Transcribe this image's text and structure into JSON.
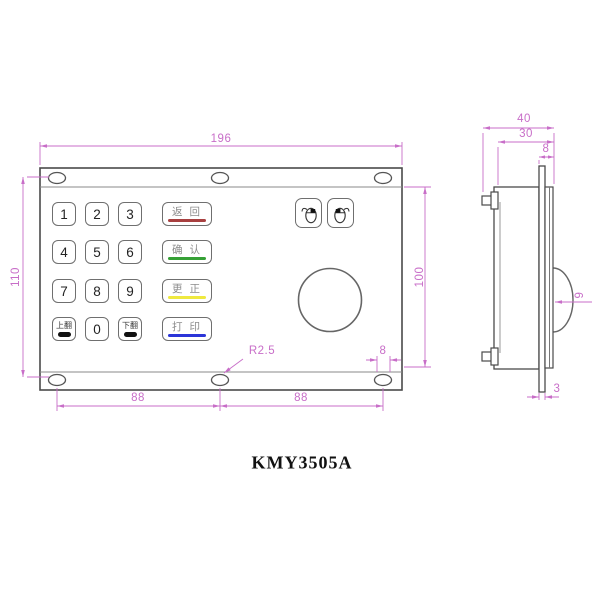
{
  "title": "KMY3505A",
  "colors": {
    "dimension_lines": "#c86ec8",
    "drawing_outline": "#4a4a4a",
    "underline_red": "#a84040",
    "underline_green": "#35a035",
    "underline_yellow": "#efe93f",
    "underline_blue": "#2b35d8",
    "underline_black": "#111111"
  },
  "front_view": {
    "keypad": {
      "rows": [
        {
          "keys": [
            {
              "label": "1"
            },
            {
              "label": "2"
            },
            {
              "label": "3"
            },
            {
              "label": "返 回",
              "underline": "#a84040"
            }
          ]
        },
        {
          "keys": [
            {
              "label": "4"
            },
            {
              "label": "5"
            },
            {
              "label": "6"
            },
            {
              "label": "确 认",
              "underline": "#35a035"
            }
          ]
        },
        {
          "keys": [
            {
              "label": "7"
            },
            {
              "label": "8"
            },
            {
              "label": "9"
            },
            {
              "label": "更 正",
              "underline": "#efe93f"
            }
          ]
        },
        {
          "keys": [
            {
              "label": "上翻",
              "underline": "#111111"
            },
            {
              "label": "0"
            },
            {
              "label": "下翻",
              "underline": "#111111"
            },
            {
              "label": "打 印",
              "underline": "#2b35d8"
            }
          ]
        }
      ]
    },
    "pointer": {
      "left_button_icon": "mouse-left-click-icon",
      "right_button_icon": "mouse-right-click-icon",
      "trackball": "trackball"
    },
    "dimensions": {
      "width": "196",
      "mount_height": "110",
      "panel_height": "100",
      "hole_pitch_left": "88",
      "hole_pitch_right": "88",
      "slot_length": "8",
      "slot_radius": "R2.5"
    }
  },
  "side_view": {
    "dimensions": {
      "total_depth": "40",
      "body_depth": "30",
      "bezel_offset": "8",
      "ball_protrusion": "9",
      "plate_thickness": "3"
    }
  }
}
